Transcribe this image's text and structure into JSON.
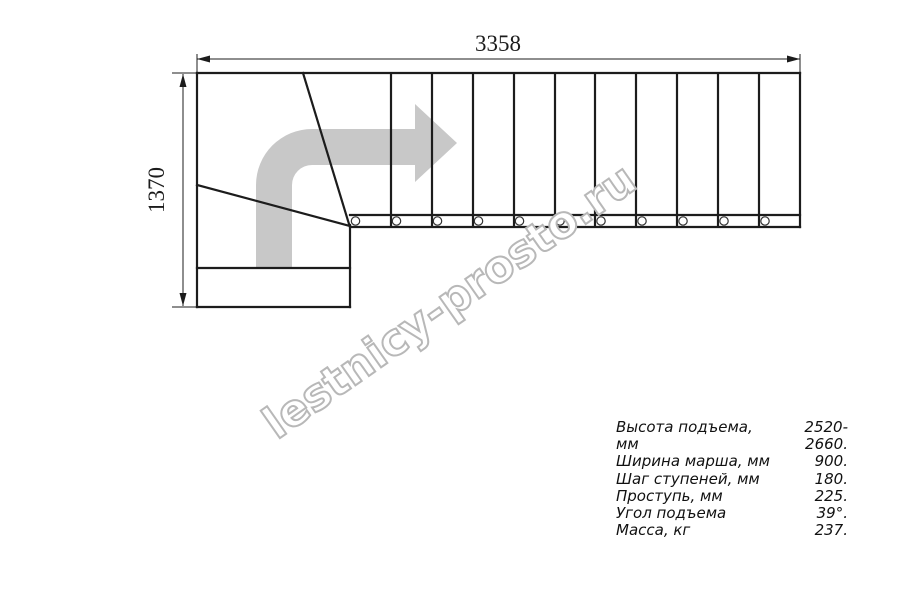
{
  "drawing": {
    "top_dimension_label": "3358",
    "left_dimension_label": "1370",
    "straight_flight_treads": 11,
    "winder_treads": 3,
    "baluster_circles": 11
  },
  "watermark": {
    "text": "lestnicy-prosto.ru"
  },
  "specs": {
    "rows": [
      {
        "label": "Высота подъема, мм",
        "value": "2520-2660."
      },
      {
        "label": "Ширина марша, мм",
        "value": "900."
      },
      {
        "label": "Шаг ступеней, мм",
        "value": "180."
      },
      {
        "label": "Проступь, мм",
        "value": "225."
      },
      {
        "label": "Угол подъема",
        "value": "39°."
      },
      {
        "label": "Масса, кг",
        "value": "237."
      }
    ]
  },
  "icons": {
    "direction_arrow": "thick-curved-arrow-up-then-right"
  },
  "colors": {
    "line": "#1c1c1c",
    "arrow_gray": "#c8c8c8",
    "watermark_outline": "#b8b8b8",
    "background": "#ffffff"
  }
}
